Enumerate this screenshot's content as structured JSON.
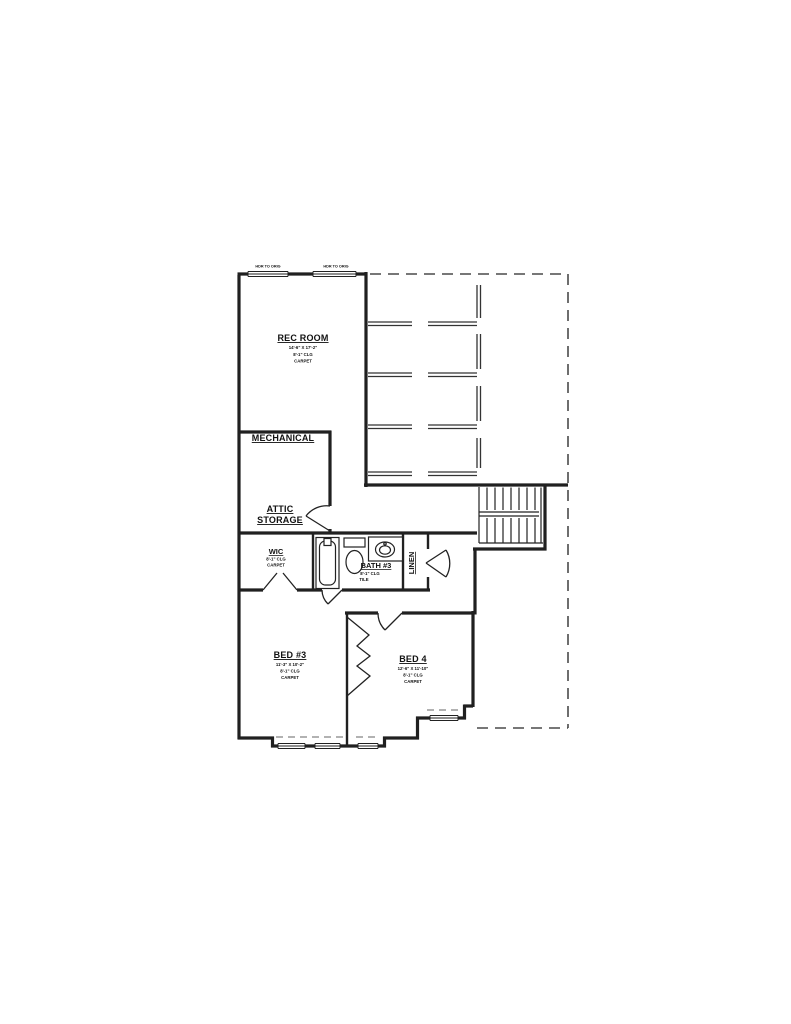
{
  "page": {
    "background": "#ffffff",
    "line_color": "#202020",
    "type": "second-floor architectural floor plan"
  },
  "plan": {
    "window_notes": [
      {
        "label": "HDR TO ORIG"
      },
      {
        "label": "HDR TO ORIG"
      }
    ],
    "rooms": {
      "rec_room": {
        "name": "REC ROOM",
        "dims": "14'-6\" X 17'-2\"",
        "ceiling": "8'-1\" CLG",
        "floor": "CARPET"
      },
      "mechanical": {
        "name": "MECHANICAL"
      },
      "attic_storage": {
        "name_line1": "ATTIC",
        "name_line2": "STORAGE"
      },
      "wic": {
        "name": "WIC",
        "ceiling": "8'-1\" CLG",
        "floor": "CARPET"
      },
      "bath3": {
        "name": "BATH #3",
        "ceiling": "8'-1\" CLG",
        "floor": "TILE"
      },
      "linen": {
        "name": "LINEN"
      },
      "bed3": {
        "name": "BED #3",
        "dims": "11'-3\" X 10'-2\"",
        "ceiling": "8'-1\" CLG",
        "floor": "CARPET"
      },
      "bed4": {
        "name": "BED 4",
        "dims": "12'-6\" X 11'-10\"",
        "ceiling": "8'-1\" CLG",
        "floor": "CARPET"
      }
    }
  }
}
